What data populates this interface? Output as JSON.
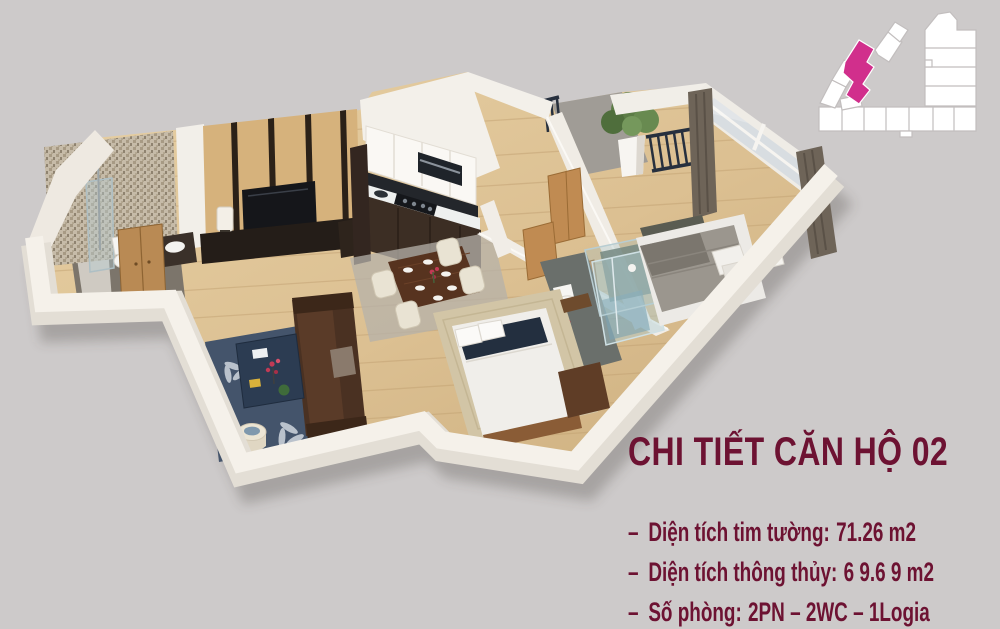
{
  "colors": {
    "bg": "#cdcaca",
    "ink": "#6d1232",
    "accent": "#d12f8c",
    "wall": "#f2eee7",
    "floor": "#dcc092"
  },
  "title": {
    "text": "CHI TIẾT CĂN HỘ 02"
  },
  "details": {
    "lines": [
      {
        "dash": "–",
        "label": "Diện tích tim tường:",
        "value": "71.26 m2"
      },
      {
        "dash": "–",
        "label": "Diện tích thông thủy:",
        "value": "6 9.6 9 m2"
      },
      {
        "dash": "–",
        "label": "Số phòng:",
        "value": "2PN – 2WC – 1Logia"
      }
    ]
  }
}
